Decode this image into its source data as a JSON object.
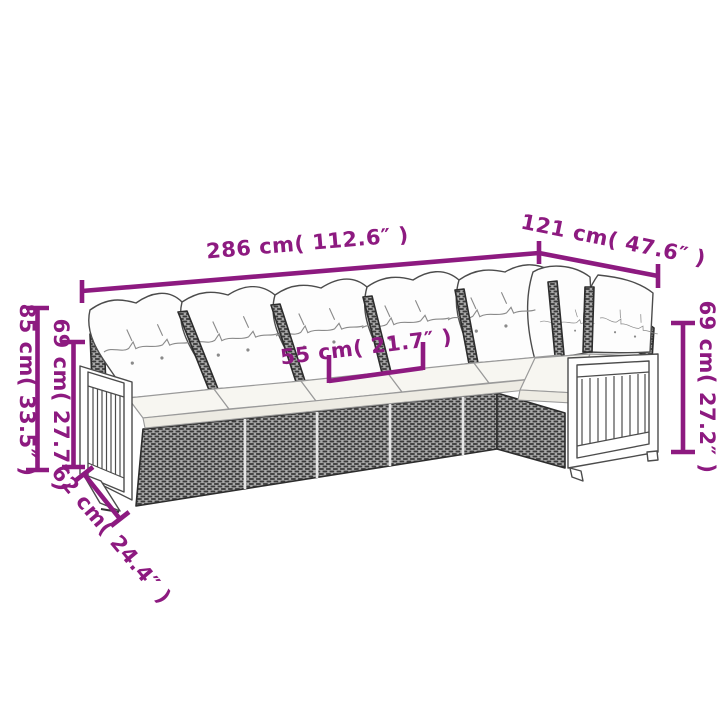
{
  "page": {
    "background": "#ffffff",
    "accent_color": "#8d1a80",
    "illustration": "l-shaped-rattan-garden-sofa-line-art",
    "parts": {
      "back_pillows": "white back cushions (7)",
      "seat_cushions": "white seat cushions",
      "base": "dark grey poly rattan base",
      "left_armrest": "wood slat armrest panel",
      "right_armrest": "wood slat armrest panel"
    }
  },
  "dimensions": {
    "total_length": "286 cm( 112.6″ )",
    "side_depth": "121 cm( 47.6″ )",
    "seat_width": "55 cm( 21.7″ )",
    "back_height": "85 cm( 33.5″ )",
    "seat_back_height_left": "69 cm( 27.7″ )",
    "armrest_height_right": "69 cm( 27.2″ )",
    "seat_depth": "62 cm( 24.4″ )"
  }
}
